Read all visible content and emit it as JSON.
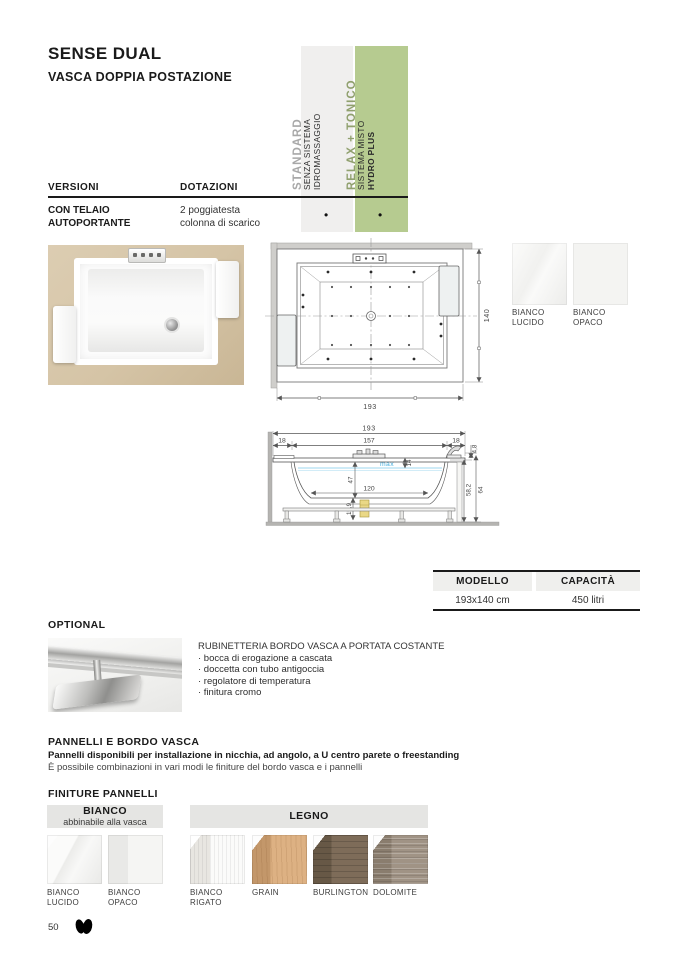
{
  "page": {
    "title": "SENSE DUAL",
    "subtitle": "VASCA DOPPIA POSTAZIONE",
    "page_number": "50"
  },
  "colors": {
    "accent_green": "#b6cb90",
    "column_gray": "#f0efee",
    "water_blue": "#45aede"
  },
  "spec_columns": {
    "standard": {
      "title": "STANDARD",
      "line1": "SENZA SISTEMA",
      "line2": "IDROMASSAGGIO"
    },
    "relax": {
      "title": "RELAX + TONICO",
      "line1": "SISTEMA MISTO",
      "line2": "HYDRO PLUS"
    }
  },
  "versions_table": {
    "col1_header": "VERSIONI",
    "col2_header": "DOTAZIONI",
    "row": {
      "version_line1": "CON TELAIO",
      "version_line2": "AUTOPORTANTE",
      "equip_line1": "2 poggiatesta",
      "equip_line2": "colonna di scarico",
      "standard_dot": "•",
      "relax_dot": "•"
    }
  },
  "tub_finishes": {
    "items": [
      {
        "line1": "BIANCO",
        "line2": "LUCIDO"
      },
      {
        "line1": "BIANCO",
        "line2": "OPACO"
      }
    ]
  },
  "drawing_top": {
    "width": "193",
    "height": "140"
  },
  "drawing_side": {
    "total_width": "193",
    "left_edge": "18",
    "center_width": "157",
    "right_edge": "18",
    "rim_height": "4,8",
    "water_label": "max",
    "water_gap": "14",
    "inner_depth": "47",
    "bottom_width": "120",
    "drain_clearance": "15,9",
    "panel_height": "58,2",
    "total_height": "64"
  },
  "model_table": {
    "col1_header": "MODELLO",
    "col2_header": "CAPACITÀ",
    "model": "193x140 cm",
    "capacity": "450 litri"
  },
  "optional": {
    "heading": "OPTIONAL",
    "title": "RUBINETTERIA BORDO VASCA A PORTATA COSTANTE",
    "items": [
      "· bocca di erogazione a cascata",
      "· doccetta con tubo antigoccia",
      "· regolatore di temperatura",
      "· finitura cromo"
    ]
  },
  "panels": {
    "heading": "PANNELLI E BORDO VASCA",
    "desc_bold": "Pannelli disponibili per installazione in nicchia, ad angolo, a U centro parete o freestanding",
    "desc_regular": "È possibile combinazioni in vari modi le finiture del bordo vasca e i pannelli",
    "finishes_heading": "FINITURE PANNELLI",
    "group_bianco_title": "BIANCO",
    "group_bianco_sub": "abbinabile alla vasca",
    "group_legno_title": "LEGNO",
    "swatches": [
      {
        "line1": "BIANCO",
        "line2": "LUCIDO"
      },
      {
        "line1": "BIANCO",
        "line2": "OPACO"
      },
      {
        "line1": "BIANCO",
        "line2": "RIGATO"
      },
      {
        "line1": "GRAIN",
        "line2": ""
      },
      {
        "line1": "BURLINGTON",
        "line2": ""
      },
      {
        "line1": "DOLOMITE",
        "line2": ""
      }
    ]
  }
}
